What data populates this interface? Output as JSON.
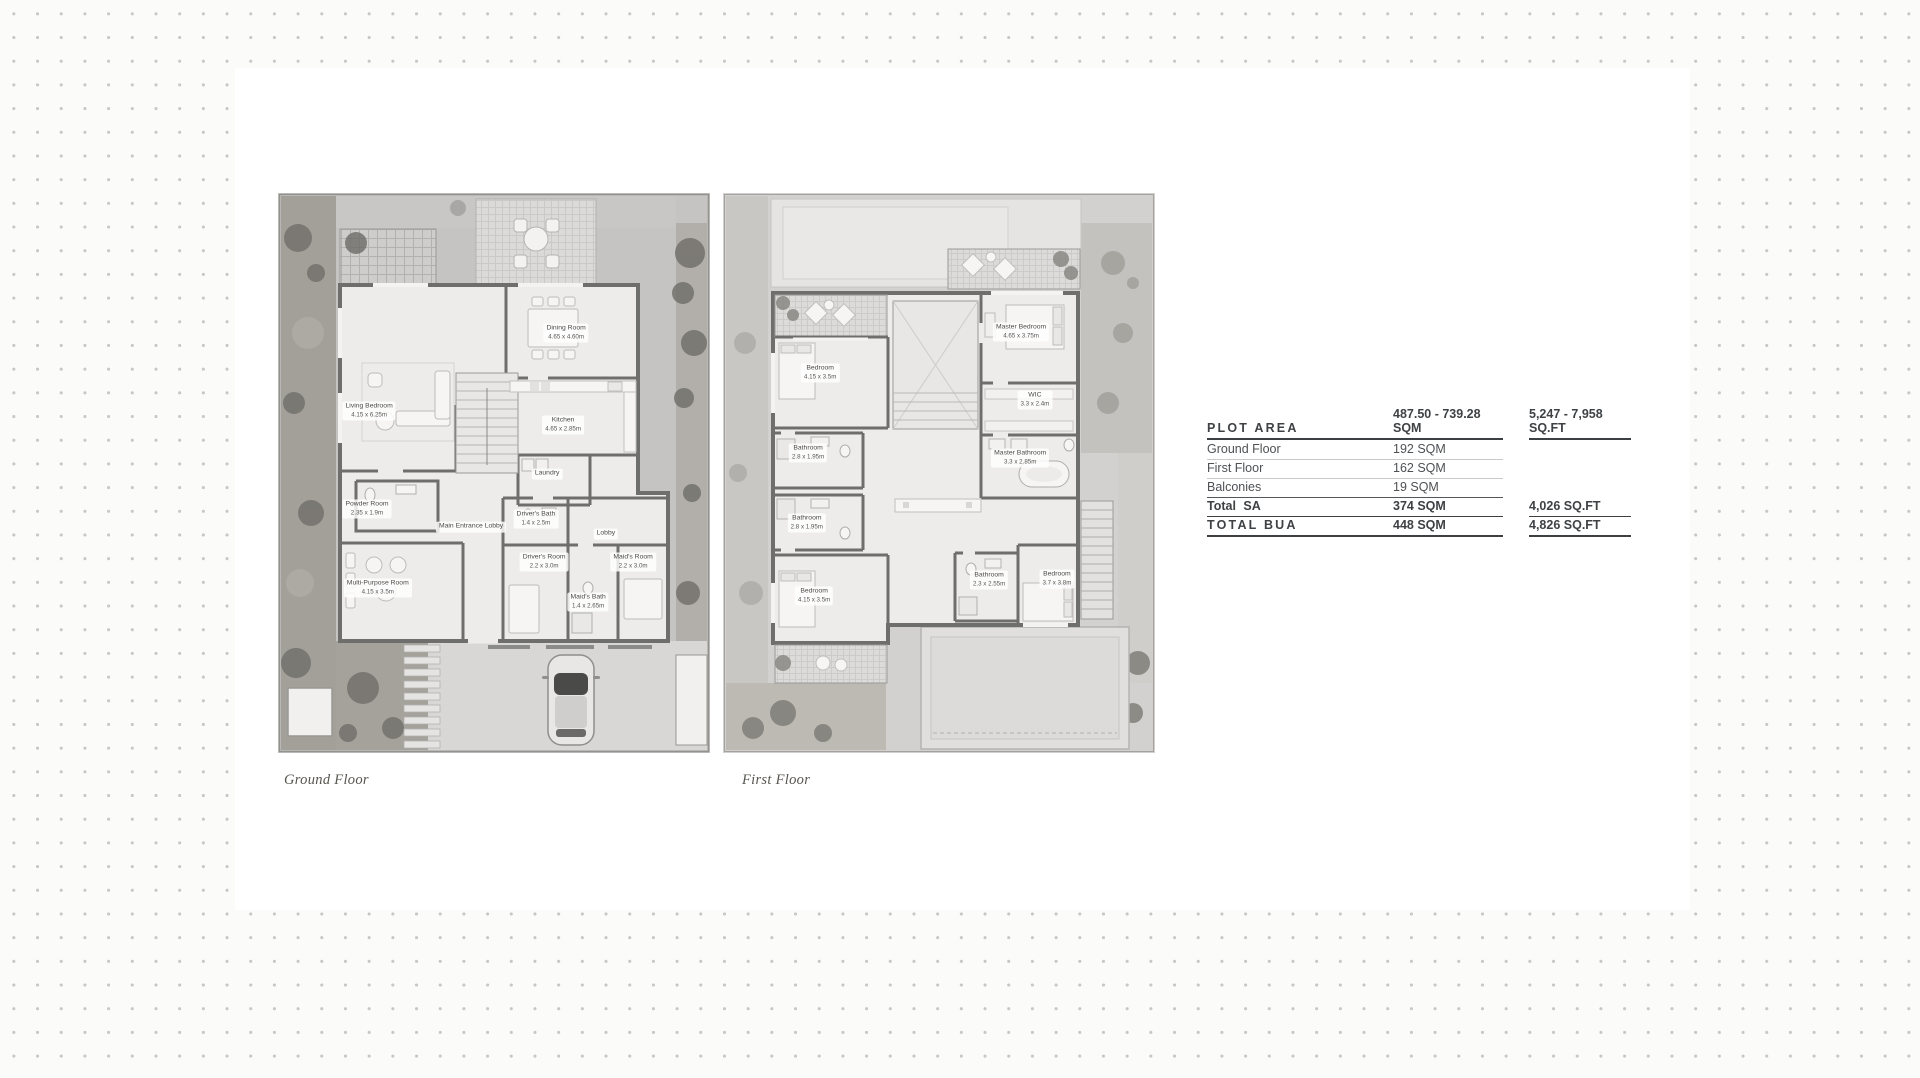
{
  "plans": [
    {
      "id": "ground",
      "caption": "Ground Floor",
      "rooms": [
        {
          "name": "Living Bedroom",
          "dims": "4.15 x 6.25m"
        },
        {
          "name": "Dining Room",
          "dims": "4.65 x 4.60m"
        },
        {
          "name": "Kitchen",
          "dims": "4.65 x 2.85m"
        },
        {
          "name": "Laundry",
          "dims": ""
        },
        {
          "name": "Powder Room",
          "dims": "2.35 x 1.9m"
        },
        {
          "name": "Main Entrance Lobby",
          "dims": ""
        },
        {
          "name": "Driver's Bath",
          "dims": "1.4 x 2.5m"
        },
        {
          "name": "Driver's Room",
          "dims": "2.2 x 3.0m"
        },
        {
          "name": "Lobby",
          "dims": ""
        },
        {
          "name": "Maid's Room",
          "dims": "2.2 x 3.0m"
        },
        {
          "name": "Maid's Bath",
          "dims": "1.4 x 2.65m"
        },
        {
          "name": "Multi-Purpose Room",
          "dims": "4.15 x 3.5m"
        }
      ]
    },
    {
      "id": "first",
      "caption": "First Floor",
      "rooms": [
        {
          "name": "Bedroom",
          "dims": "4.15 x 3.5m"
        },
        {
          "name": "Master Bedroom",
          "dims": "4.65 x 3.75m"
        },
        {
          "name": "WIC",
          "dims": "3.3 x 2.4m"
        },
        {
          "name": "Bathroom",
          "dims": "2.8 x 1.95m"
        },
        {
          "name": "Master Bathroom",
          "dims": "3.3 x 2.85m"
        },
        {
          "name": "Bathroom",
          "dims": "2.8 x 1.95m"
        },
        {
          "name": "Bedroom",
          "dims": "4.15 x 3.5m"
        },
        {
          "name": "Bathroom",
          "dims": "2.3 x 2.55m"
        },
        {
          "name": "Bedroom",
          "dims": "3.7 x 3.8m"
        }
      ]
    }
  ],
  "area_table": {
    "rows": [
      {
        "label": "PLOT AREA",
        "sqm": "487.50 - 739.28 SQM",
        "sqft": "5,247 - 7,958 SQ.FT",
        "style": "header"
      },
      {
        "label": "Ground Floor",
        "sqm": "192 SQM",
        "sqft": "",
        "style": "light"
      },
      {
        "label": "First Floor",
        "sqm": "162 SQM",
        "sqft": "",
        "style": "light"
      },
      {
        "label": "Balconies",
        "sqm": "19 SQM",
        "sqft": "",
        "style": "dark"
      },
      {
        "label": "Total SA",
        "sqm": "374 SQM",
        "sqft": "4,026 SQ.FT",
        "style": "total"
      },
      {
        "label": "TOTAL BUA",
        "sqm": "448 SQM",
        "sqft": "4,826 SQ.FT",
        "style": "grand"
      }
    ]
  }
}
